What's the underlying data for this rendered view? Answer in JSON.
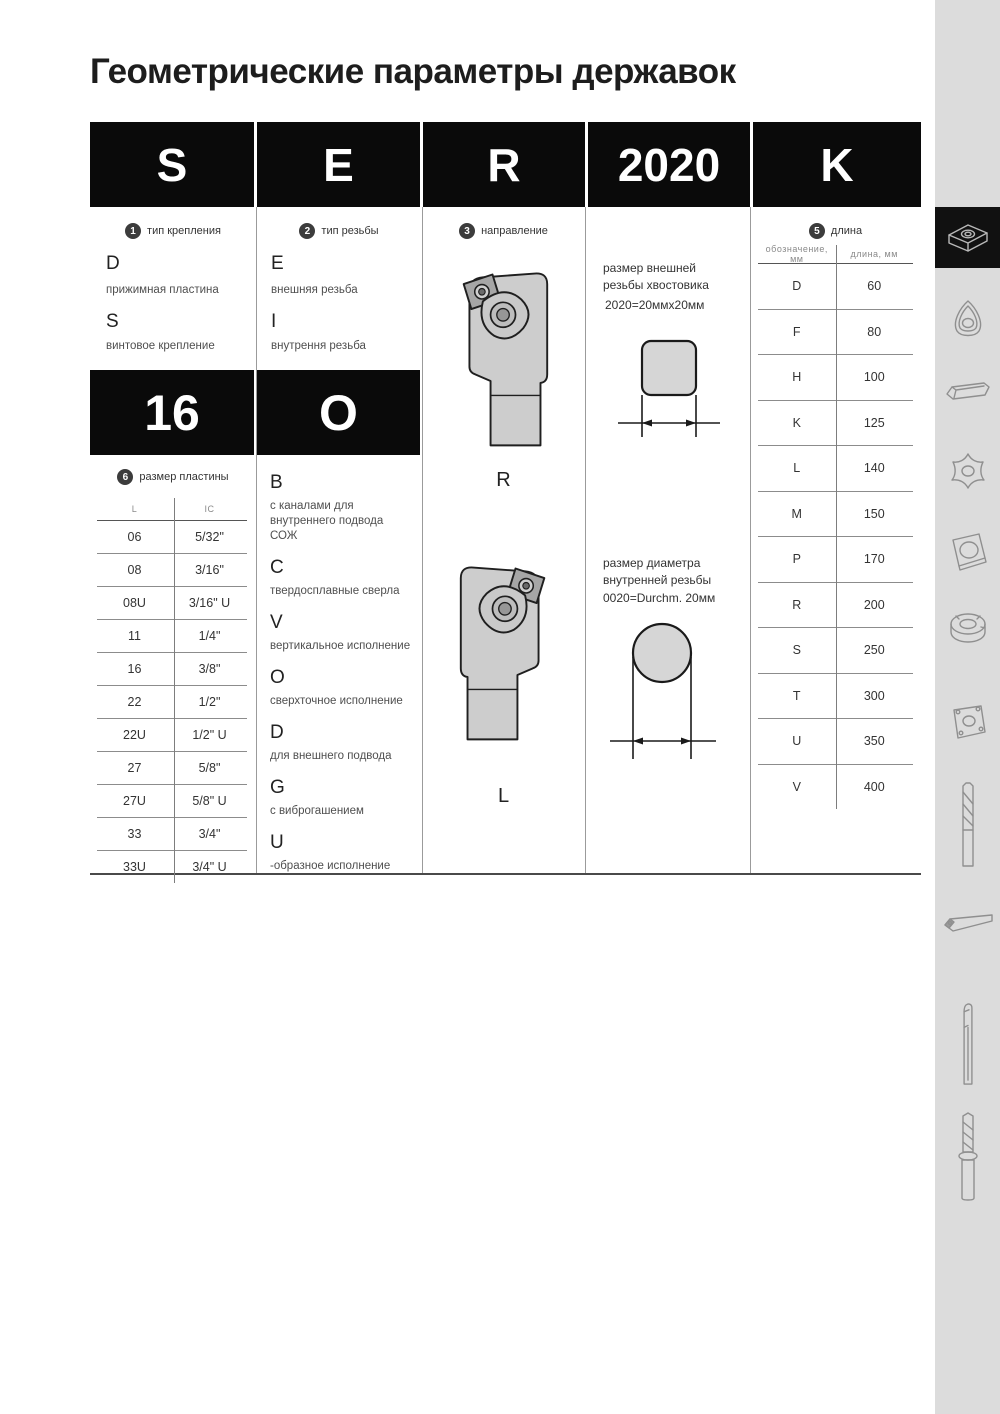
{
  "page": {
    "title": "Геометрические параметры державок"
  },
  "code_header": {
    "cells": [
      "S",
      "E",
      "R",
      "2020",
      "K"
    ]
  },
  "columns": {
    "mounting": {
      "badge": "1",
      "label": "тип крепления",
      "items": [
        {
          "code": "D",
          "desc": "прижимная пластина"
        },
        {
          "code": "S",
          "desc": "винтовое крепление"
        }
      ],
      "code_cell": "16",
      "insert_size": {
        "badge": "6",
        "label": "размер пластины",
        "headers": [
          "L",
          "IC"
        ],
        "rows": [
          [
            "06",
            "5/32\""
          ],
          [
            "08",
            "3/16\""
          ],
          [
            "08U",
            "3/16\" U"
          ],
          [
            "11",
            "1/4\""
          ],
          [
            "16",
            "3/8\""
          ],
          [
            "22",
            "1/2\""
          ],
          [
            "22U",
            "1/2\" U"
          ],
          [
            "27",
            "5/8\""
          ],
          [
            "27U",
            "5/8\" U"
          ],
          [
            "33",
            "3/4\""
          ],
          [
            "33U",
            "3/4\" U"
          ]
        ]
      }
    },
    "thread": {
      "badge": "2",
      "label": "тип резьбы",
      "items": [
        {
          "code": "E",
          "desc": "внешняя резьба"
        },
        {
          "code": "I",
          "desc": "внутрення резьба"
        }
      ],
      "code_cell": "O",
      "options": [
        {
          "code": "B",
          "desc": "с каналами для внутреннего подвода СОЖ"
        },
        {
          "code": "C",
          "desc": "твердосплавные сверла"
        },
        {
          "code": "V",
          "desc": "вертикальное исполнение"
        },
        {
          "code": "O",
          "desc": "сверхточное исполнение"
        },
        {
          "code": "D",
          "desc": "для внешнего подвода"
        },
        {
          "code": "G",
          "desc": "с виброгашением"
        },
        {
          "code": "U",
          "desc": "-образное исполнение"
        }
      ]
    },
    "direction": {
      "badge": "3",
      "label": "направление",
      "variants": [
        "R",
        "L"
      ]
    },
    "shank": {
      "external": {
        "text": "размер внешней резьбы хвостовика",
        "size": "2020=20ммх20мм"
      },
      "internal": {
        "text": "размер диаметра внутренней резьбы",
        "size": "0020=Durchm. 20мм"
      }
    },
    "length": {
      "badge": "5",
      "label": "длина",
      "headers": [
        "обозначение, мм",
        "длина, мм"
      ],
      "rows": [
        [
          "D",
          "60"
        ],
        [
          "F",
          "80"
        ],
        [
          "H",
          "100"
        ],
        [
          "K",
          "125"
        ],
        [
          "L",
          "140"
        ],
        [
          "M",
          "150"
        ],
        [
          "P",
          "170"
        ],
        [
          "R",
          "200"
        ],
        [
          "S",
          "250"
        ],
        [
          "T",
          "300"
        ],
        [
          "U",
          "350"
        ],
        [
          "V",
          "400"
        ]
      ]
    }
  },
  "sidebar": {
    "active_index": 0,
    "icons": [
      "square-turning-insert",
      "trigon-insert",
      "grooving-insert",
      "threading-insert",
      "square-insert-round-hole",
      "round-milling-cutter",
      "square-milling-insert",
      "end-mill",
      "turning-toolholder",
      "boring-bar",
      "drill"
    ]
  },
  "colors": {
    "accent_black": "#0a0a0a",
    "sidebar_bg": "#dcdcdc",
    "diagram_fill": "#d6d6d6"
  }
}
